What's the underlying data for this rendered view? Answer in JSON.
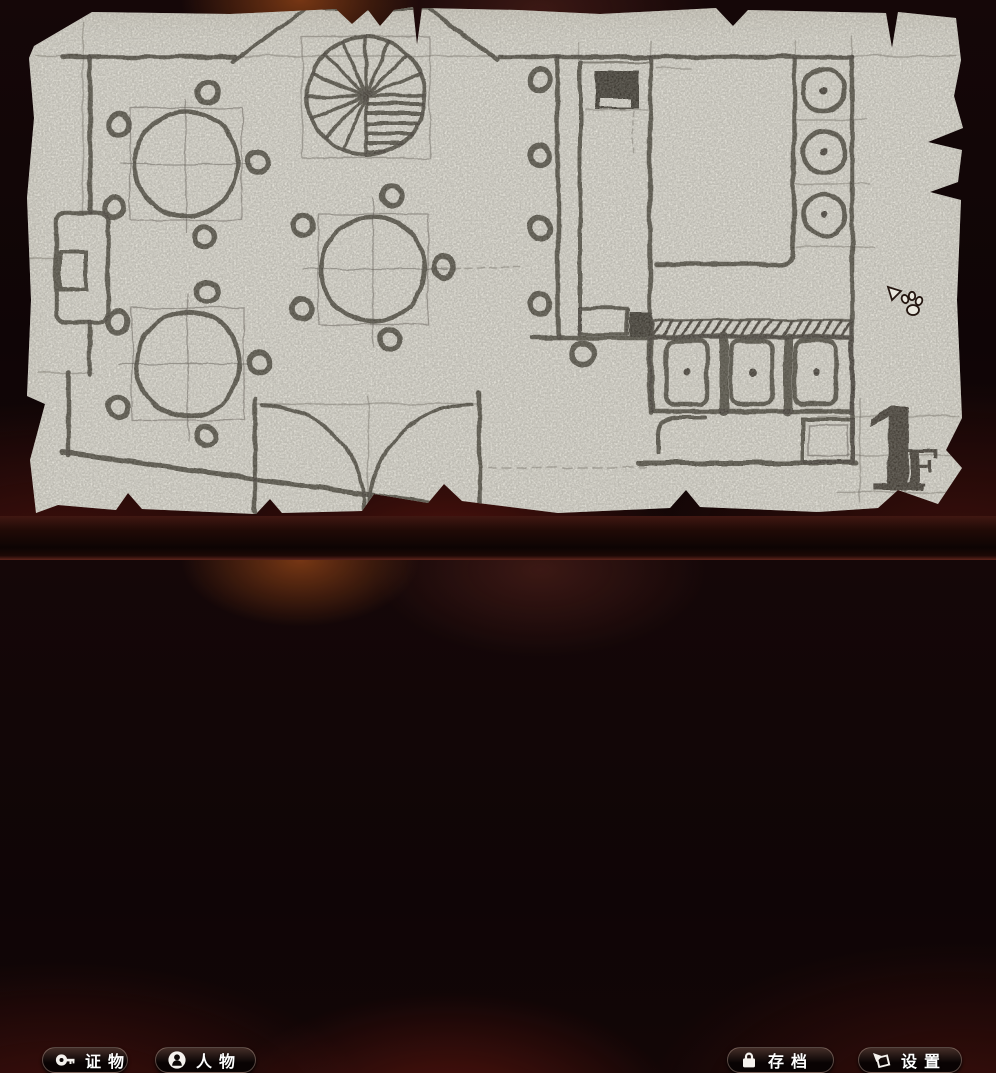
{
  "map": {
    "floor_number": "1",
    "floor_suffix": "F"
  },
  "hud": {
    "buttons": [
      {
        "id": "evidence",
        "label": "证物",
        "icon": "key-icon"
      },
      {
        "id": "characters",
        "label": "人物",
        "icon": "person-icon"
      },
      {
        "id": "save",
        "label": "存档",
        "icon": "lock-icon"
      },
      {
        "id": "settings",
        "label": "设置",
        "icon": "pointer-icon"
      }
    ]
  },
  "cursor": {
    "icon": "paw-cursor-icon"
  },
  "colors": {
    "paper": "#eae8df",
    "ink": "#3b362f",
    "bar_top": "#401812",
    "bar_bottom_glow": "#5e251c",
    "button_bg": "#0d0807",
    "label_text": "#ffffff"
  }
}
